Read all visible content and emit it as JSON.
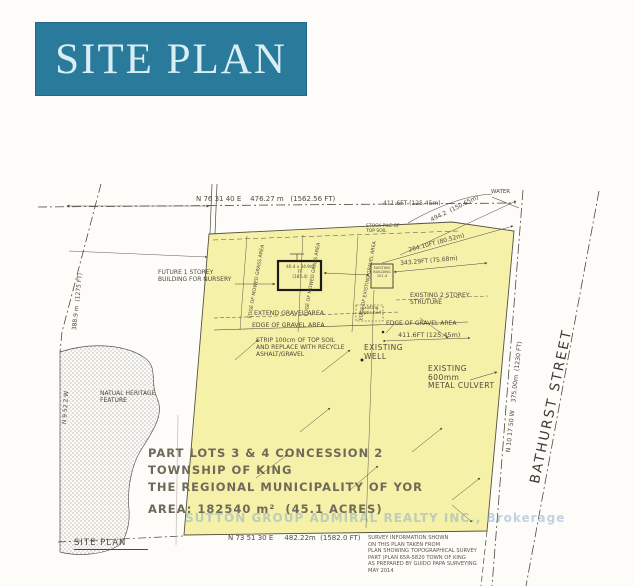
{
  "banner": {
    "title": "SITE PLAN"
  },
  "colors": {
    "banner_bg": "#2a7a9b",
    "banner_text": "#d9eff5",
    "parcel_fill": "#f5f0a1",
    "ink": "#4c4a3e",
    "watermark": "#7da5cd"
  },
  "dimensions": {
    "north": "N 76 31 40 E    476.27 m   (1562.56 FT)",
    "north_right": "411.6FT (125.45m)",
    "mid_right": "411.6FT (125.45m)",
    "diag_long": "494.2  (150.65m)",
    "diag_short": "264.10FT (80.52m)",
    "between_buildings": "343.29FT (75.68m)",
    "west_bearing": "N 9 52 2 W",
    "west_length": "388.9 m  (1275 FT)",
    "east_bearing": "N 10 17 50 W    375.00m  (1230 FT)",
    "south": "N 73 51 30 E     482.22m  (1582.0 FT)"
  },
  "street": {
    "name": "BATHURST STREET"
  },
  "labels": {
    "future_building": "FUTURE 1 STOREY\nBUILDING FOR NURSERY",
    "stockpile": "STOCK PILE OF\nTOP SOIL",
    "water": "WATER",
    "building1": "40.4 x 34.9m\nFF\n(185.4)",
    "building2": "EXISTING\nBUILDING\n101.4",
    "structure": "EXISTING 2 STOREY\nSTRUTURE",
    "septic": "Existing\nseptic bed",
    "extend_gravel": "EXTEND GRAVEL AREA",
    "edge_gravel_left": "EDGE OF GRAVEL AREA",
    "edge_gravel_right": "EDGE OF GRAVEL AREA",
    "strip": "STRIP 100cm OF TOP SOIL\nAND REPLACE WITH RECYCLE\nASHALT/GRAVEL",
    "well": "EXISTING\nWELL",
    "culvert": "EXISTING\n600mm\nMETAL CULVERT",
    "edge_mowed_1": "EDGE OF MOWED GRASS AREA",
    "edge_mowed_2": "EDGE OF MOWED GRASS AREA",
    "edge_existing_gravel": "EDGE OF EXISTING GRAVEL AREA",
    "natural_feature": "NATUAL HERITAGE\nFEATURE"
  },
  "legal": {
    "line1": "PART LOTS 3 & 4 CONCESSION 2",
    "line2": "TOWNSHIP OF KING",
    "line3": "THE REGIONAL MUNICIPALITY OF YOR",
    "area": "AREA: 182540 m²  (45.1 ACRES)"
  },
  "footer": {
    "site_plan_label": "SITE PLAN",
    "survey_note": "SURVEY INFORMATION SHOWN\nON THIS PLAN TAKEN FROM\nPLAN SHOWING TOPOGRAPHICAL SURVEY\nPART (PLAN 65R-5820 TOWN OF KING\nAS PREPARED BY GUIDO PAPA SURVEYING\nMAY 2014"
  },
  "watermark": {
    "text": "SUTTON GROUP ADMIRAL REALTY INC., Brokerage"
  }
}
